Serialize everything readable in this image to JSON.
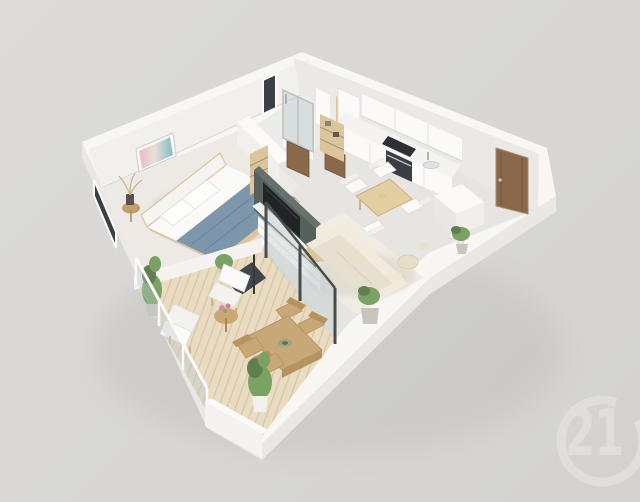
{
  "image": {
    "type": "3d-floor-plan-render",
    "description": "Isometric dollhouse-style 3D rendering of a one-bedroom apartment with a wrap balcony, shown on a plain grey background",
    "width": 640,
    "height": 502
  },
  "watermark": {
    "brand": "Century 21",
    "icon": "century-21-logo",
    "number": "21",
    "color": "#e1e0dd"
  },
  "palette": {
    "bgTop": "#dcdbd9",
    "bgMid": "#d8d7d5",
    "bgBottom": "#d3d2d0",
    "logo": "#e1e0dd",
    "wallMass": "#f8f7f4",
    "slabEdge": "#eae8e4",
    "wallFaceNW": "#f2f0ec",
    "wallFaceNE": "#ebe9e5",
    "wallFaceOuter": "#f4f3f0",
    "white": "#fbfaf8",
    "floorMain": "#e7e5e1",
    "floorBedroom": "#edeae5",
    "floorBath": "#ebebe8",
    "deck": "#e9dcc3",
    "deckLine": "#d7c5a4",
    "rug": "#f0ece1",
    "accentWall": "#56615b",
    "tv": "#202427",
    "sofa": "#e7dfd0",
    "sofaLight": "#f2ebdd",
    "blanket": "#7e96ab",
    "bench": "#41464b",
    "woodLight": "#dcc49c",
    "woodMid": "#c8a877",
    "doorBrown": "#8a694b",
    "glassTint": "rgba(186,200,206,0.38)",
    "frameDark": "#474c4f",
    "metal": "#b9bfc1",
    "cooktop": "#2d3134",
    "windowDark": "#3a4046",
    "plantGreen": "#7ba265",
    "plantDark": "#5f7f4e",
    "potLight": "#c9c5be",
    "decorBeige": "#e7dfc9",
    "brass": "#bfa06a",
    "driedPlant": "#c9b28b"
  },
  "rooms": [
    {
      "name": "bedroom",
      "items": [
        "double-bed",
        "headboard",
        "pillows",
        "blue-throw-blanket",
        "foot-bench",
        "wall-art",
        "brass-side-table",
        "dried-plant-vase",
        "ladder-shelf",
        "floor-lamp",
        "window"
      ]
    },
    {
      "name": "bathroom",
      "items": [
        "walk-in-shower",
        "glass-screen",
        "vanity-sink",
        "towel-shelf",
        "window",
        "wooden-door",
        "second-door"
      ]
    },
    {
      "name": "kitchen",
      "items": [
        "upper-cabinets",
        "base-cabinets",
        "cooktop",
        "oven",
        "sink",
        "tall-cabinet",
        "open-shelf"
      ]
    },
    {
      "name": "dining-area",
      "items": [
        "dining-table",
        "dining-chairs-x4"
      ]
    },
    {
      "name": "living-room",
      "items": [
        "sofa",
        "lumbar-cushion",
        "coffee-table",
        "area-rug",
        "tv",
        "tv-accent-wall",
        "media-console",
        "potted-plant",
        "pouf",
        "floor-decor"
      ]
    },
    {
      "name": "entry",
      "items": [
        "entrance-door",
        "storage-cabinet",
        "floor-pots"
      ]
    },
    {
      "name": "balcony",
      "items": [
        "wood-deck",
        "glass-railing",
        "parapet-wall",
        "lounge-chair-1",
        "lounge-chair-2",
        "flower-side-table",
        "outdoor-dining-table",
        "outdoor-chairs-x4",
        "column-plant",
        "tall-plant",
        "corner-plant"
      ]
    }
  ],
  "scene": {
    "view": "isometric-dollhouse",
    "style": "photoreal-3d-render"
  }
}
